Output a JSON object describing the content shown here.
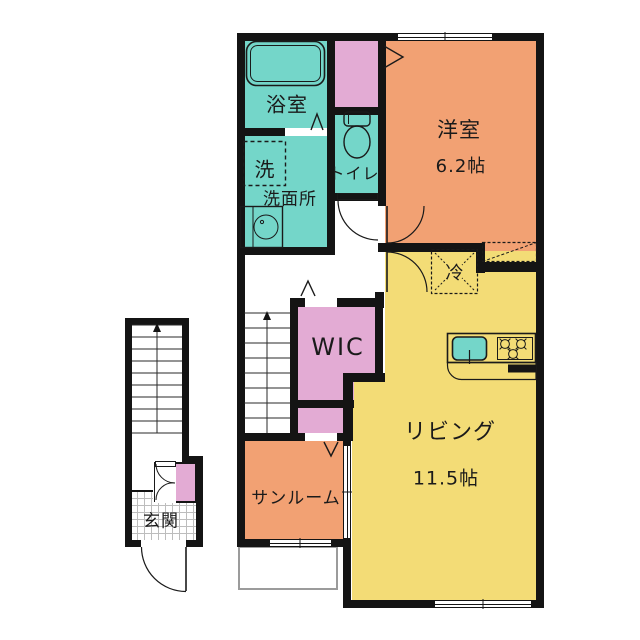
{
  "plan": {
    "title": "1LDK apartment floor plan",
    "rooms": {
      "bathroom": {
        "label": "浴室"
      },
      "laundry": {
        "label": "洗"
      },
      "washroom": {
        "label": "洗面所"
      },
      "toilet": {
        "label": "トイレ"
      },
      "western_room": {
        "label": "洋室",
        "size": "6.2帖"
      },
      "refrigerator": {
        "label": "冷"
      },
      "wic": {
        "label": "WIC"
      },
      "living": {
        "label": "リビング",
        "size": "11.5帖"
      },
      "sunroom": {
        "label": "サンルーム"
      },
      "entrance": {
        "label": "玄関"
      }
    },
    "colors": {
      "wall": "#141414",
      "wet_area_teal": "#74D6C9",
      "room_orange": "#F2A173",
      "living_yellow": "#F3DC76",
      "storage_pink": "#E3ABD4"
    }
  }
}
